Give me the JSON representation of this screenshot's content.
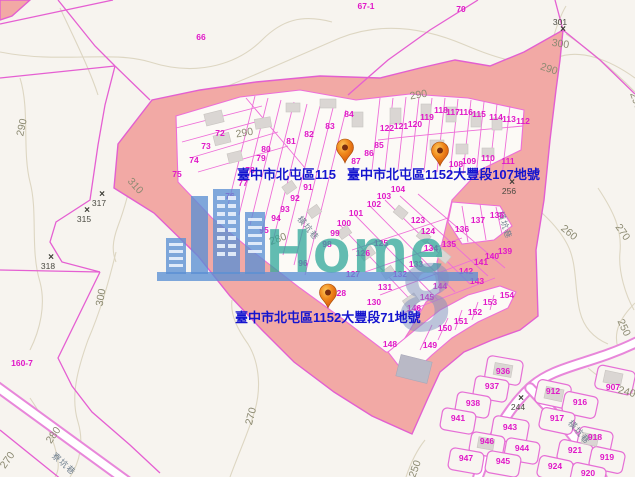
{
  "map": {
    "watermark": {
      "brand": "Home",
      "eight": "8"
    },
    "colors": {
      "highlight_pink": "#f2a9a5",
      "boundary_magenta": "#e35fd0",
      "parcel_number_magenta": "#e018c8",
      "label_blue": "#1414cf",
      "pin_orange": "#f08a1d",
      "watermark_teal": "#2fa89a",
      "watermark_blue": "#5b8fd4",
      "contour_tan": "#ddd6c2"
    },
    "pins": [
      {
        "name": "pin-1152-87",
        "x": 345,
        "tip_y": 163
      },
      {
        "name": "pin-1152-107",
        "x": 440,
        "tip_y": 166
      },
      {
        "name": "pin-1152-71",
        "x": 328,
        "tip_y": 308
      }
    ],
    "pin_labels": [
      {
        "text": "臺中市北屯區115",
        "x": 237,
        "y": 179
      },
      {
        "text": "臺中市北屯區1152大豐段107地號",
        "x": 347,
        "y": 179
      },
      {
        "text": "臺中市北屯區1152大豐段71地號",
        "x": 235,
        "y": 322
      }
    ],
    "parcel_numbers": [
      {
        "t": "66",
        "x": 201,
        "y": 40
      },
      {
        "t": "67-1",
        "x": 366,
        "y": 9
      },
      {
        "t": "70",
        "x": 461,
        "y": 12
      },
      {
        "t": "160-7",
        "x": 22,
        "y": 366
      },
      {
        "t": "72",
        "x": 220,
        "y": 136
      },
      {
        "t": "73",
        "x": 206,
        "y": 149
      },
      {
        "t": "74",
        "x": 194,
        "y": 163
      },
      {
        "t": "75",
        "x": 177,
        "y": 177
      },
      {
        "t": "76",
        "x": 230,
        "y": 199
      },
      {
        "t": "77",
        "x": 243,
        "y": 186
      },
      {
        "t": "78",
        "x": 250,
        "y": 173
      },
      {
        "t": "79",
        "x": 261,
        "y": 161
      },
      {
        "t": "80",
        "x": 266,
        "y": 152
      },
      {
        "t": "81",
        "x": 291,
        "y": 144
      },
      {
        "t": "82",
        "x": 309,
        "y": 137
      },
      {
        "t": "83",
        "x": 330,
        "y": 129
      },
      {
        "t": "84",
        "x": 349,
        "y": 117
      },
      {
        "t": "85",
        "x": 379,
        "y": 148
      },
      {
        "t": "86",
        "x": 369,
        "y": 156
      },
      {
        "t": "87",
        "x": 356,
        "y": 164
      },
      {
        "t": "91",
        "x": 308,
        "y": 190
      },
      {
        "t": "92",
        "x": 295,
        "y": 201
      },
      {
        "t": "93",
        "x": 285,
        "y": 212
      },
      {
        "t": "94",
        "x": 276,
        "y": 221
      },
      {
        "t": "95",
        "x": 264,
        "y": 233
      },
      {
        "t": "96",
        "x": 303,
        "y": 266
      },
      {
        "t": "98",
        "x": 327,
        "y": 247
      },
      {
        "t": "99",
        "x": 335,
        "y": 236
      },
      {
        "t": "100",
        "x": 344,
        "y": 226
      },
      {
        "t": "101",
        "x": 356,
        "y": 216
      },
      {
        "t": "102",
        "x": 374,
        "y": 207
      },
      {
        "t": "103",
        "x": 384,
        "y": 199
      },
      {
        "t": "104",
        "x": 398,
        "y": 192
      },
      {
        "t": "108",
        "x": 456,
        "y": 167
      },
      {
        "t": "109",
        "x": 469,
        "y": 164
      },
      {
        "t": "110",
        "x": 488,
        "y": 161
      },
      {
        "t": "111",
        "x": 508,
        "y": 164
      },
      {
        "t": "112",
        "x": 523,
        "y": 124
      },
      {
        "t": "113",
        "x": 509,
        "y": 122
      },
      {
        "t": "114",
        "x": 496,
        "y": 120
      },
      {
        "t": "115",
        "x": 479,
        "y": 117
      },
      {
        "t": "116",
        "x": 466,
        "y": 115
      },
      {
        "t": "117",
        "x": 453,
        "y": 115
      },
      {
        "t": "118",
        "x": 441,
        "y": 113
      },
      {
        "t": "119",
        "x": 427,
        "y": 120
      },
      {
        "t": "120",
        "x": 415,
        "y": 127
      },
      {
        "t": "121",
        "x": 401,
        "y": 129
      },
      {
        "t": "122",
        "x": 387,
        "y": 131
      },
      {
        "t": "123",
        "x": 418,
        "y": 223
      },
      {
        "t": "124",
        "x": 428,
        "y": 234
      },
      {
        "t": "125",
        "x": 381,
        "y": 246
      },
      {
        "t": "126",
        "x": 363,
        "y": 256
      },
      {
        "t": "127",
        "x": 353,
        "y": 277
      },
      {
        "t": "128",
        "x": 339,
        "y": 296
      },
      {
        "t": "130",
        "x": 374,
        "y": 305
      },
      {
        "t": "131",
        "x": 385,
        "y": 290
      },
      {
        "t": "132",
        "x": 400,
        "y": 277
      },
      {
        "t": "133",
        "x": 416,
        "y": 267
      },
      {
        "t": "134",
        "x": 431,
        "y": 251
      },
      {
        "t": "135",
        "x": 449,
        "y": 247
      },
      {
        "t": "136",
        "x": 462,
        "y": 232
      },
      {
        "t": "137",
        "x": 478,
        "y": 223
      },
      {
        "t": "138",
        "x": 497,
        "y": 218
      },
      {
        "t": "139",
        "x": 505,
        "y": 254
      },
      {
        "t": "140",
        "x": 492,
        "y": 259
      },
      {
        "t": "141",
        "x": 481,
        "y": 265
      },
      {
        "t": "142",
        "x": 466,
        "y": 274
      },
      {
        "t": "143",
        "x": 477,
        "y": 284
      },
      {
        "t": "144",
        "x": 440,
        "y": 289
      },
      {
        "t": "145",
        "x": 427,
        "y": 300
      },
      {
        "t": "146",
        "x": 414,
        "y": 311
      },
      {
        "t": "148",
        "x": 390,
        "y": 347
      },
      {
        "t": "149",
        "x": 430,
        "y": 348
      },
      {
        "t": "150",
        "x": 445,
        "y": 331
      },
      {
        "t": "151",
        "x": 461,
        "y": 324
      },
      {
        "t": "152",
        "x": 475,
        "y": 315
      },
      {
        "t": "153",
        "x": 490,
        "y": 305
      },
      {
        "t": "154",
        "x": 507,
        "y": 298
      },
      {
        "t": "936",
        "x": 503,
        "y": 374
      },
      {
        "t": "937",
        "x": 492,
        "y": 389
      },
      {
        "t": "938",
        "x": 473,
        "y": 406
      },
      {
        "t": "941",
        "x": 458,
        "y": 421
      },
      {
        "t": "943",
        "x": 510,
        "y": 430
      },
      {
        "t": "946",
        "x": 487,
        "y": 444
      },
      {
        "t": "944",
        "x": 522,
        "y": 451
      },
      {
        "t": "947",
        "x": 466,
        "y": 461
      },
      {
        "t": "945",
        "x": 503,
        "y": 464
      },
      {
        "t": "912",
        "x": 553,
        "y": 394
      },
      {
        "t": "916",
        "x": 580,
        "y": 405
      },
      {
        "t": "917",
        "x": 557,
        "y": 421
      },
      {
        "t": "918",
        "x": 595,
        "y": 440
      },
      {
        "t": "921",
        "x": 575,
        "y": 453
      },
      {
        "t": "919",
        "x": 607,
        "y": 460
      },
      {
        "t": "924",
        "x": 555,
        "y": 469
      },
      {
        "t": "920",
        "x": 588,
        "y": 476
      },
      {
        "t": "907",
        "x": 613,
        "y": 390
      }
    ],
    "contour_labels": [
      {
        "t": "290",
        "x": 25,
        "y": 128,
        "rot": -78
      },
      {
        "t": "310",
        "x": 133,
        "y": 188,
        "rot": 48
      },
      {
        "t": "300",
        "x": 104,
        "y": 298,
        "rot": -80
      },
      {
        "t": "280",
        "x": 56,
        "y": 437,
        "rot": -55
      },
      {
        "t": "270",
        "x": 10,
        "y": 462,
        "rot": -55
      },
      {
        "t": "270",
        "x": 254,
        "y": 417,
        "rot": -75
      },
      {
        "t": "290",
        "x": 245,
        "y": 136,
        "rot": -10
      },
      {
        "t": "290",
        "x": 419,
        "y": 98,
        "rot": -10
      },
      {
        "t": "280",
        "x": 279,
        "y": 242,
        "rot": -20
      },
      {
        "t": "300",
        "x": 560,
        "y": 47,
        "rot": 8
      },
      {
        "t": "290",
        "x": 548,
        "y": 72,
        "rot": 18
      },
      {
        "t": "290",
        "x": 633,
        "y": 102,
        "rot": 70
      },
      {
        "t": "260",
        "x": 567,
        "y": 235,
        "rot": 40
      },
      {
        "t": "270",
        "x": 620,
        "y": 234,
        "rot": 55
      },
      {
        "t": "250",
        "x": 621,
        "y": 329,
        "rot": 65
      },
      {
        "t": "240",
        "x": 626,
        "y": 395,
        "rot": 15
      },
      {
        "t": "250",
        "x": 418,
        "y": 470,
        "rot": -70
      }
    ],
    "elevation_points": [
      {
        "label": "317",
        "x": 102,
        "y": 197,
        "pos": "below"
      },
      {
        "label": "315",
        "x": 87,
        "y": 213,
        "pos": "below"
      },
      {
        "label": "318",
        "x": 51,
        "y": 260,
        "pos": "below"
      },
      {
        "label": "301",
        "x": 563,
        "y": 32,
        "pos": "above"
      },
      {
        "label": "256",
        "x": 512,
        "y": 185,
        "pos": "below"
      },
      {
        "label": "244",
        "x": 521,
        "y": 401,
        "pos": "below"
      }
    ],
    "road_labels": [
      {
        "t": "橫坑巷",
        "x": 502,
        "y": 226,
        "rot": 72
      },
      {
        "t": "橫坑巷",
        "x": 577,
        "y": 434,
        "rot": 48
      },
      {
        "t": "橫坑巷",
        "x": 306,
        "y": 230,
        "rot": 50
      },
      {
        "t": "寮坑巷",
        "x": 62,
        "y": 466,
        "rot": 42
      }
    ]
  }
}
